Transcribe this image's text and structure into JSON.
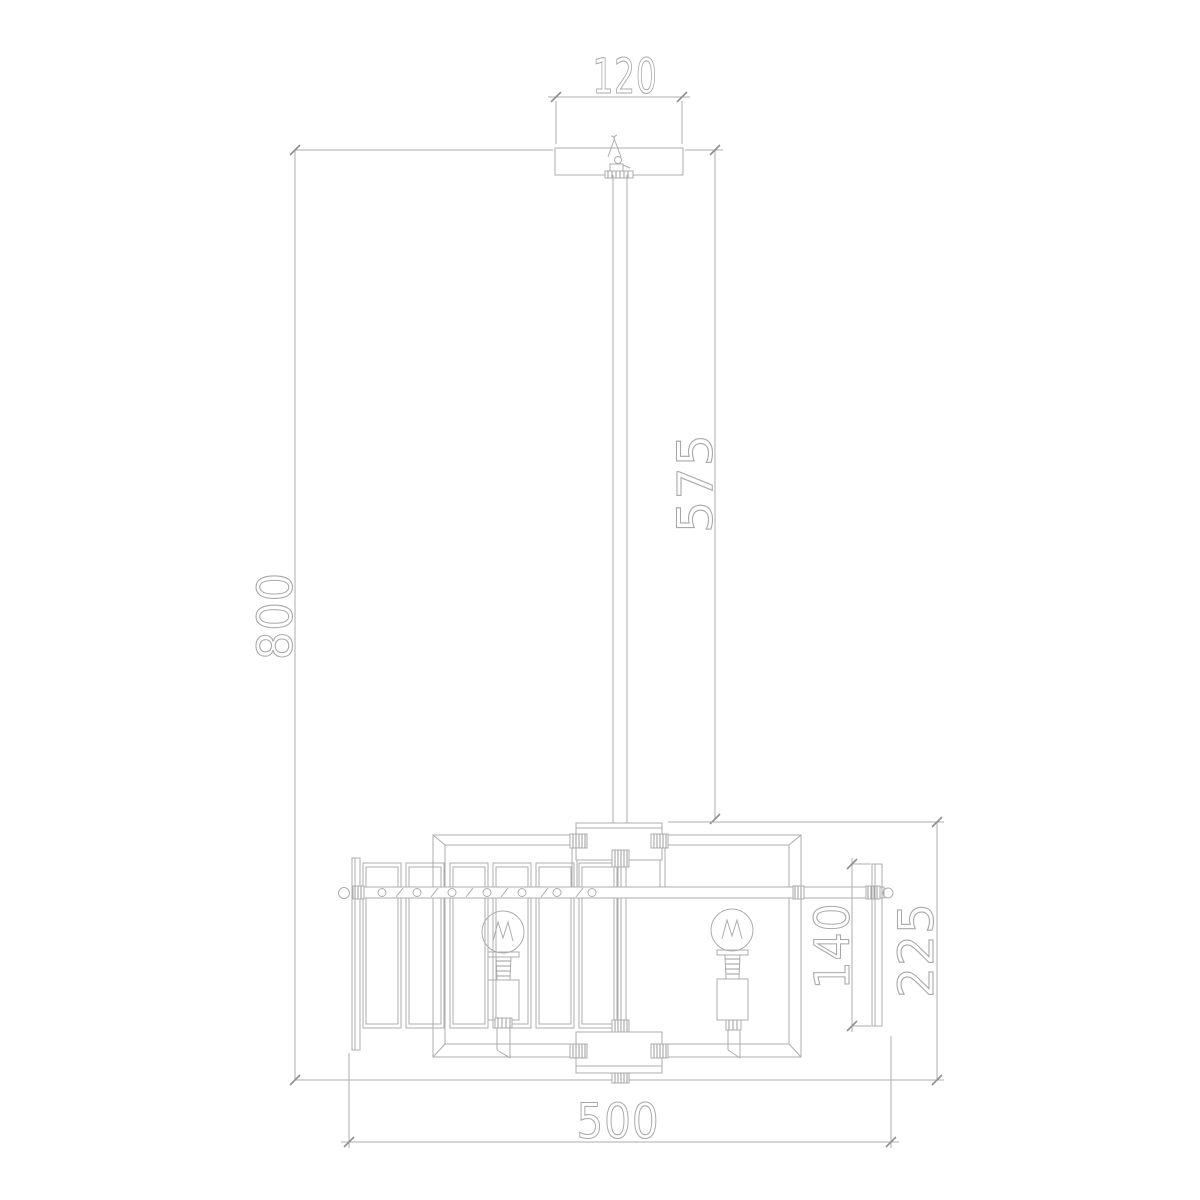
{
  "drawing": {
    "type": "technical-dimension-diagram",
    "colors": {
      "line": "#adadad",
      "text": "#a9a9a9",
      "background": "#ffffff"
    },
    "dimensions": {
      "canopy_width": "120",
      "rod_length": "575",
      "overall_height": "800",
      "end_plate_height": "140",
      "body_height": "225",
      "body_width": "500"
    }
  }
}
